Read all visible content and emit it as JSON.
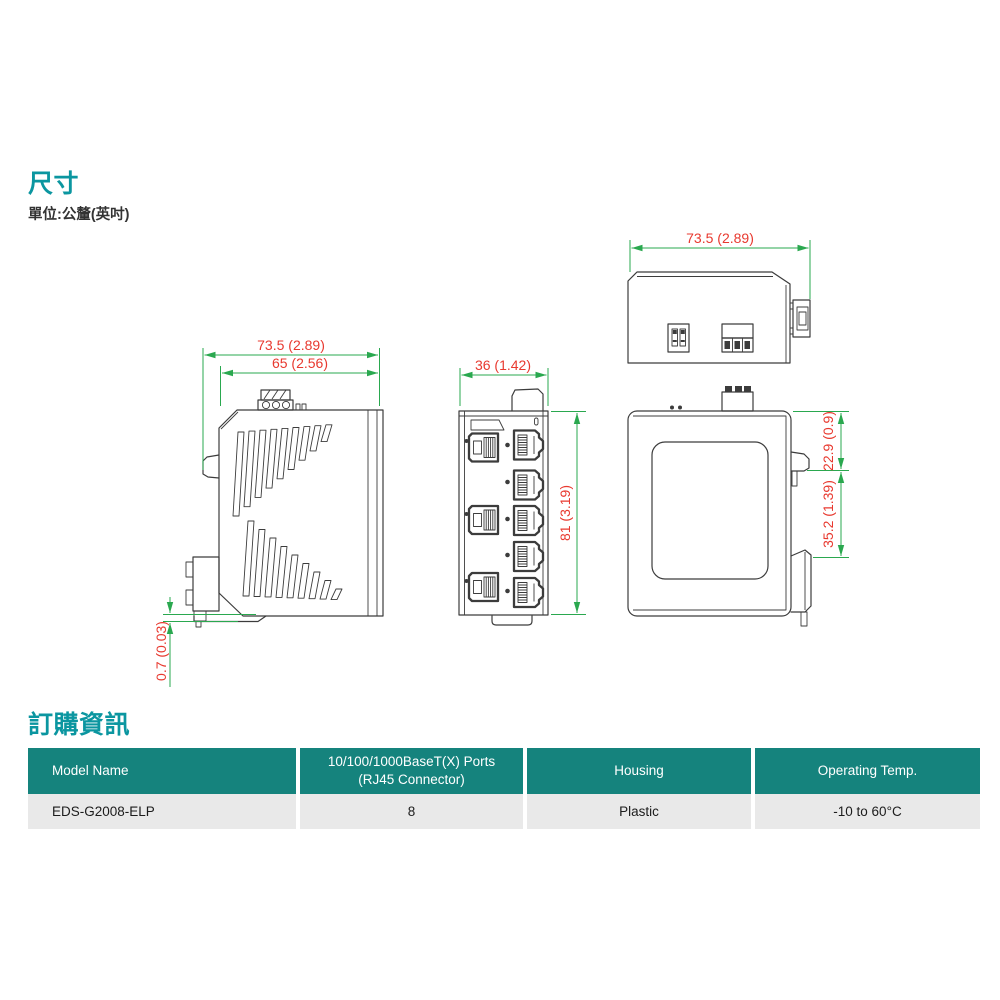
{
  "dimensions_section": {
    "title": "尺寸",
    "unit_note": "單位:公釐(英吋)"
  },
  "drawings": {
    "side_view": {
      "overall_width": "73.5 (2.89)",
      "body_width": "65 (2.56)",
      "base_plate_thickness": "0.7 (0.03)"
    },
    "front_view": {
      "width": "36 (1.42)",
      "height": "81 (3.19)"
    },
    "top_view": {
      "width": "73.5 (2.89)"
    },
    "rear_view": {
      "upper_offset": "22.9 (0.9)",
      "din_rail_span": "35.2 (1.39)"
    }
  },
  "ordering_section": {
    "title": "訂購資訊",
    "table": {
      "headers": [
        "Model Name",
        "10/100/1000BaseT(X) Ports (RJ45 Connector)",
        "Housing",
        "Operating Temp."
      ],
      "rows": [
        [
          "EDS-G2008-ELP",
          "8",
          "Plastic",
          "-10 to 60°C"
        ]
      ]
    }
  },
  "colors": {
    "heading_teal": "#0b96a0",
    "table_header_teal": "#15837d",
    "dimension_text_red": "#e8392f",
    "dimension_line_green": "#2aa84f",
    "drawing_line": "#3c3c3c"
  }
}
